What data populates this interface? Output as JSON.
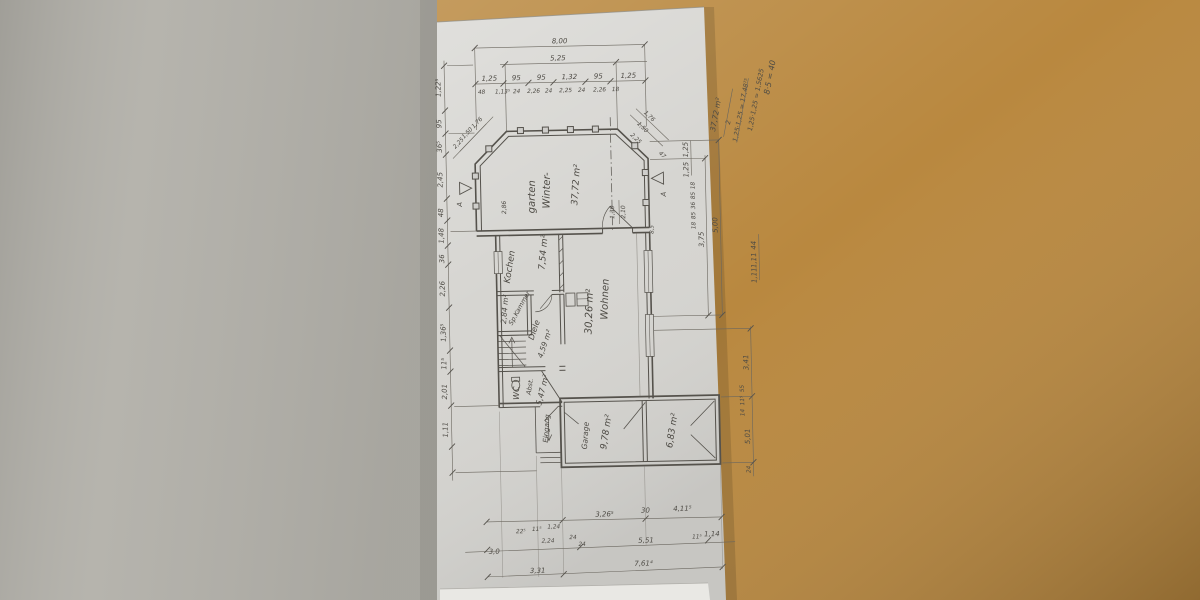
{
  "scene": {
    "description": "Photo of a pencil-drawn floor plan on paper, rotated 90 degrees, lying on a wooden desk",
    "colors": {
      "desk_wood": "#b9883f",
      "side_surface": "#b2b0a9",
      "paper": "#d6d5d1",
      "paper_edge": "#e9e8e4",
      "pencil": "#55524c"
    }
  },
  "plan": {
    "rooms": {
      "wintergarten": {
        "line1": "Winter-",
        "line2": "garten",
        "area": "37,72 m²"
      },
      "kochen": {
        "label": "Kochen",
        "area": "7,54 m²"
      },
      "spkammer": {
        "label": "Sp.Kammer",
        "area": "2,84 m²"
      },
      "diele": {
        "label": "Diele",
        "area": "4,59 m²"
      },
      "wc": {
        "label": "WC",
        "label2": "Abst.",
        "area": "5,47 m²"
      },
      "wohnen": {
        "label": "Wohnen",
        "area": "30,26 m²"
      },
      "eingang": {
        "label": "Eingang"
      },
      "garage": {
        "label": "Garage",
        "area": "9,78 m²"
      },
      "nebenraum": {
        "area": "6,83 m²"
      }
    },
    "markers": {
      "section_left": "A",
      "section_right": "A"
    },
    "door_note": {
      "width": "1,30",
      "height": "2,10"
    },
    "wall_note": "8,5",
    "left_wall_dim": "2,86",
    "calc": {
      "l1": "8·5 = 40",
      "l2": "1,25·1,25 = 1,5625",
      "l3": "1,25·1,25 = 17,48⁷⁵",
      "den": "2",
      "result": "37,72 m²"
    },
    "dims": {
      "top_overall": "8,00",
      "top_inner": "5,25",
      "top_row": [
        "1,25",
        "95",
        "95",
        "1,32",
        "95",
        "1,25"
      ],
      "top_subrow": [
        "48",
        "1,13⁵",
        "24",
        "2,26",
        "24",
        "2,25",
        "24",
        "2,26",
        "18"
      ],
      "left_col": [
        "1,22⁵",
        "95",
        "36⁵",
        "2,45",
        "48",
        "1,48",
        "36",
        "2,26",
        "1,36⁵",
        "11⁵",
        "2,01",
        "1,11"
      ],
      "right_main": [
        "1,25",
        "1,25",
        "5,00",
        "3,75"
      ],
      "right_small": [
        "18",
        "85",
        "36",
        "85",
        "18"
      ],
      "right_far": [
        "44",
        "1,11",
        "1,11"
      ],
      "right_lower": [
        "3,41",
        "55",
        "11⁵",
        "14",
        "5,01",
        "24"
      ],
      "diag_left": [
        "1,76",
        "1,50",
        "2,25"
      ],
      "diag_right": [
        "1,76",
        "1,50",
        "2,25",
        "47"
      ],
      "bottom_row1": [
        "3,26⁵",
        "30",
        "4,11⁵"
      ],
      "bottom_row1_small": [
        "22⁵",
        "11⁵",
        "1,24",
        "2,24",
        "24"
      ],
      "bottom_row2": [
        "3,0",
        "24",
        "5,51",
        "11⁵",
        "1,14"
      ],
      "bottom_row3": [
        "3,31",
        "7,61⁴"
      ]
    }
  }
}
